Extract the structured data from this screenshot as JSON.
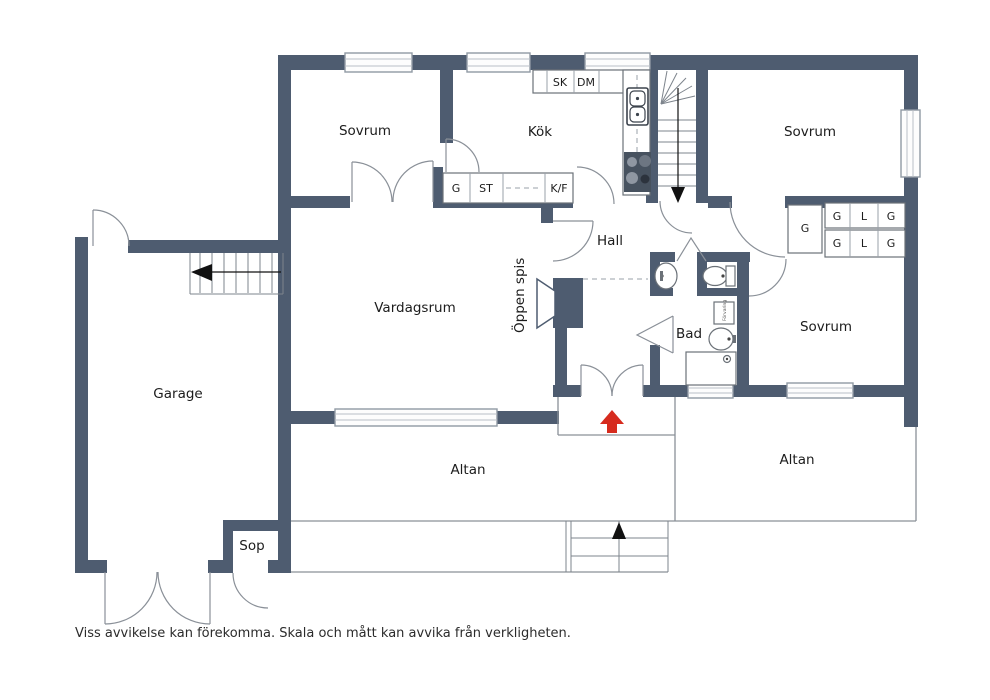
{
  "plan": {
    "rooms": {
      "bedroom1": "Sovrum",
      "kitchen": "Kök",
      "bedroom2": "Sovrum",
      "bedroom3": "Sovrum",
      "hall": "Hall",
      "living_room": "Vardagsrum",
      "fireplace": "Öppen spis",
      "bathroom": "Bad",
      "garage": "Garage",
      "waste_room": "Sop",
      "terrace_left": "Altan",
      "terrace_right": "Altan"
    },
    "kitchen_units": {
      "pantry": "SK",
      "dishwasher": "DM",
      "wardrobe": "G",
      "cleaning_closet": "ST",
      "fridge_freezer": "K/F"
    },
    "closets": {
      "hall_wardrobe": "G",
      "row1": [
        "G",
        "L",
        "G"
      ],
      "row2": [
        "G",
        "L",
        "G"
      ],
      "storage_cabinet": "Förvaring"
    },
    "disclaimer": "Viss avvikelse kan förekomma. Skala och mått kan avvika från verkligheten.",
    "colors": {
      "wall": "#4e5c70",
      "thin_line": "#8a9098",
      "entrance_arrow": "#d62b1e",
      "label_text": "#1c1c1c"
    }
  }
}
